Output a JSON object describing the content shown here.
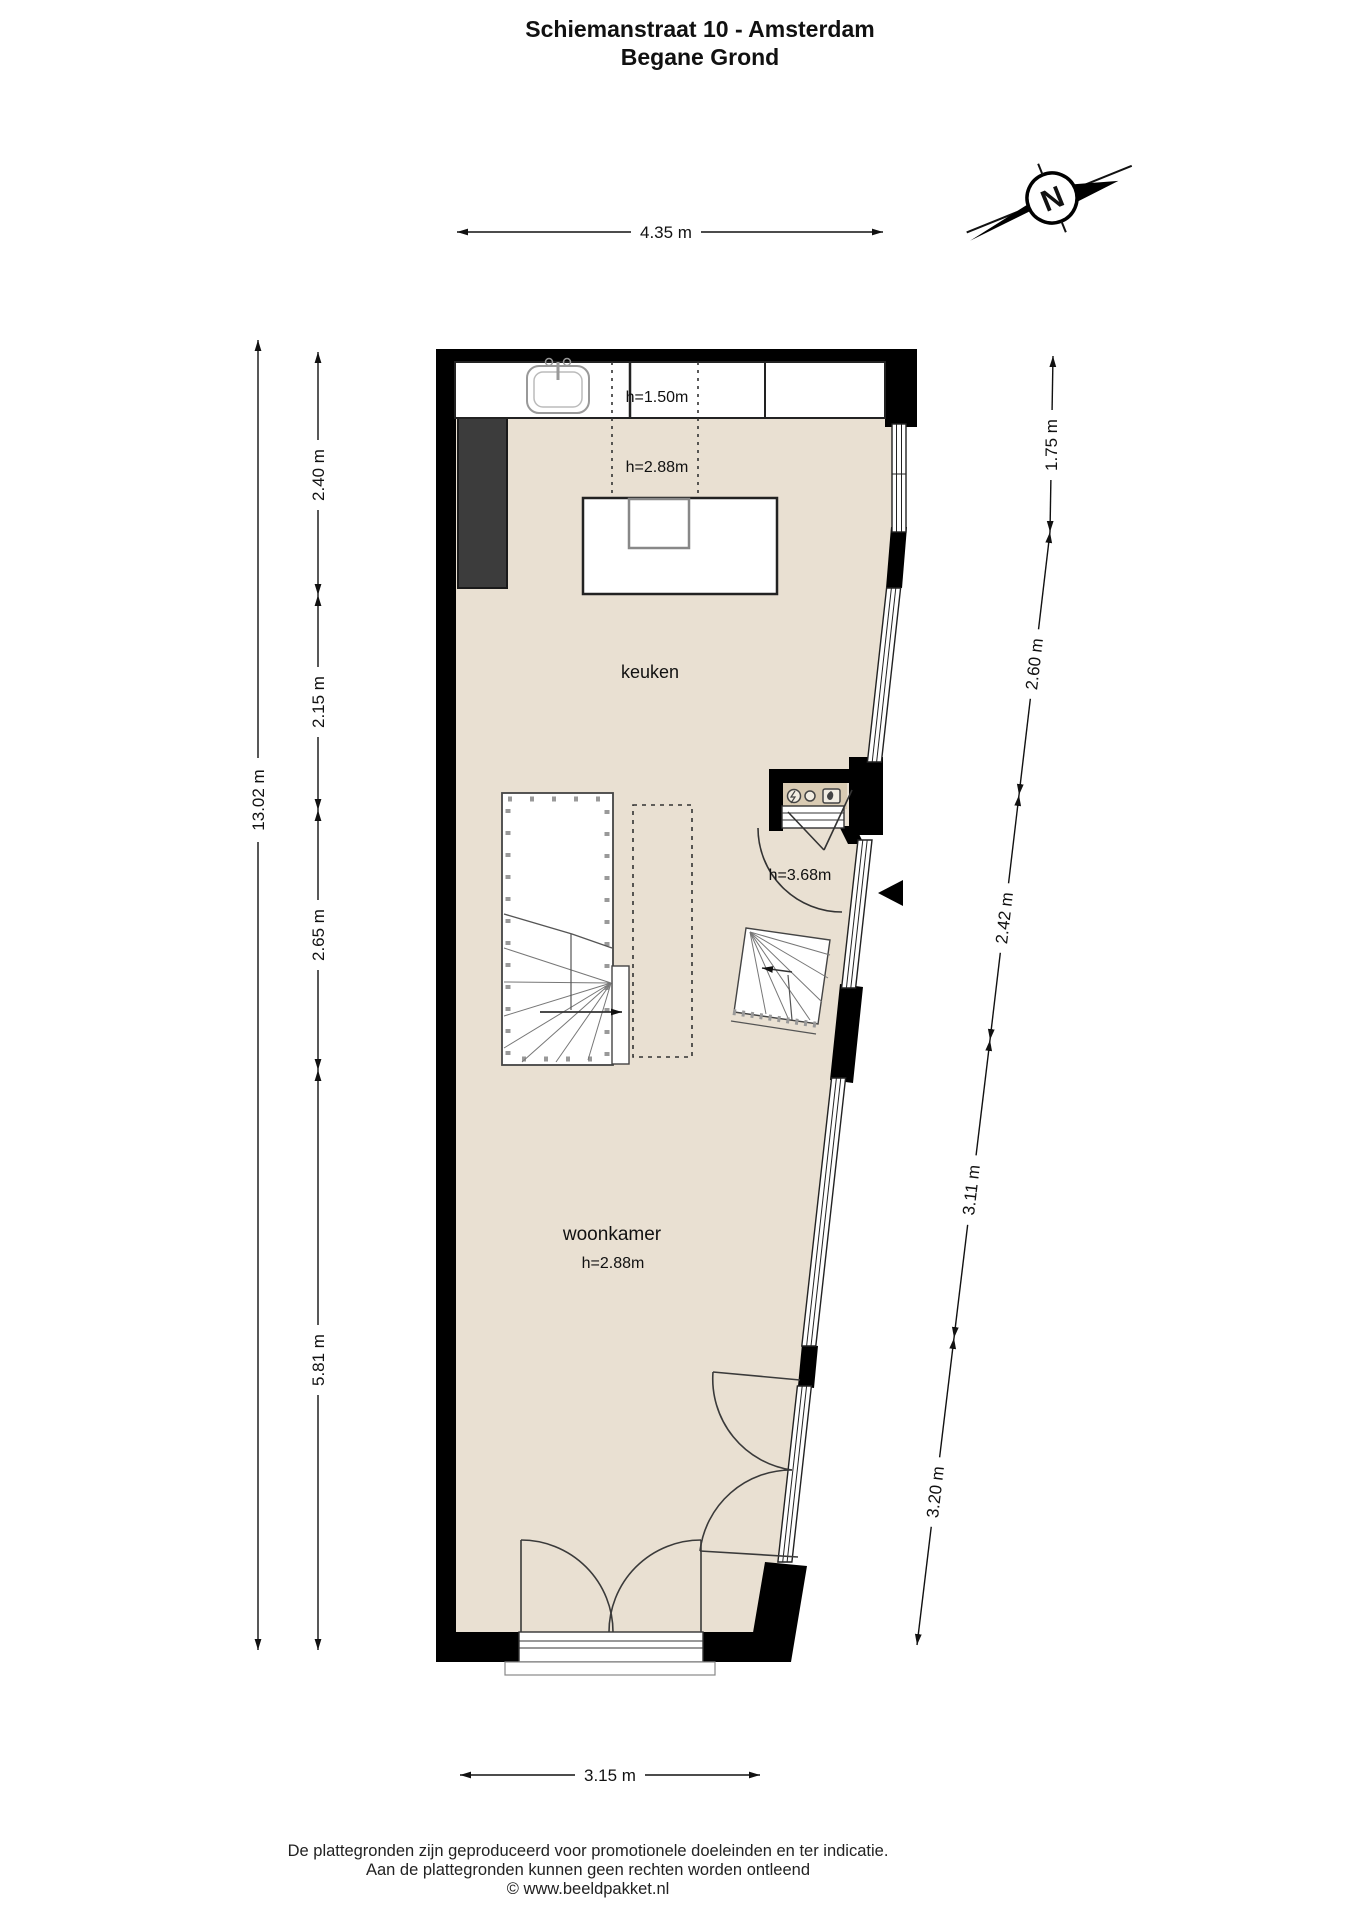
{
  "title": {
    "line1": "Schiemanstraat 10 - Amsterdam",
    "line2": "Begane Grond"
  },
  "compass": {
    "label": "N"
  },
  "dimensions": {
    "top": "4.35 m",
    "bottom": "3.15 m",
    "left_total": "13.02 m",
    "left_segments": [
      "2.40 m",
      "2.15 m",
      "2.65 m",
      "5.81 m"
    ],
    "right_segments": [
      "1.75 m",
      "2.60 m",
      "2.42 m",
      "3.11 m",
      "3.20 m"
    ]
  },
  "labels": {
    "kitchen": "keuken",
    "kitchen_height": "h=2.88m",
    "counter_height": "h=1.50m",
    "living": "woonkamer",
    "living_height": "h=2.88m",
    "hall_height": "h=3.68m"
  },
  "footer": {
    "line1": "De plattegronden zijn geproduceerd voor promotionele doeleinden en ter indicatie.",
    "line2": "Aan de plattegronden kunnen geen rechten worden ontleend",
    "line3": "© www.beeldpakket.nl"
  },
  "colors": {
    "wall": "#000000",
    "floor": "#e9e0d2",
    "shaft": "#3c3c3c",
    "niche": "#d9cbb3",
    "line": "#333333"
  }
}
